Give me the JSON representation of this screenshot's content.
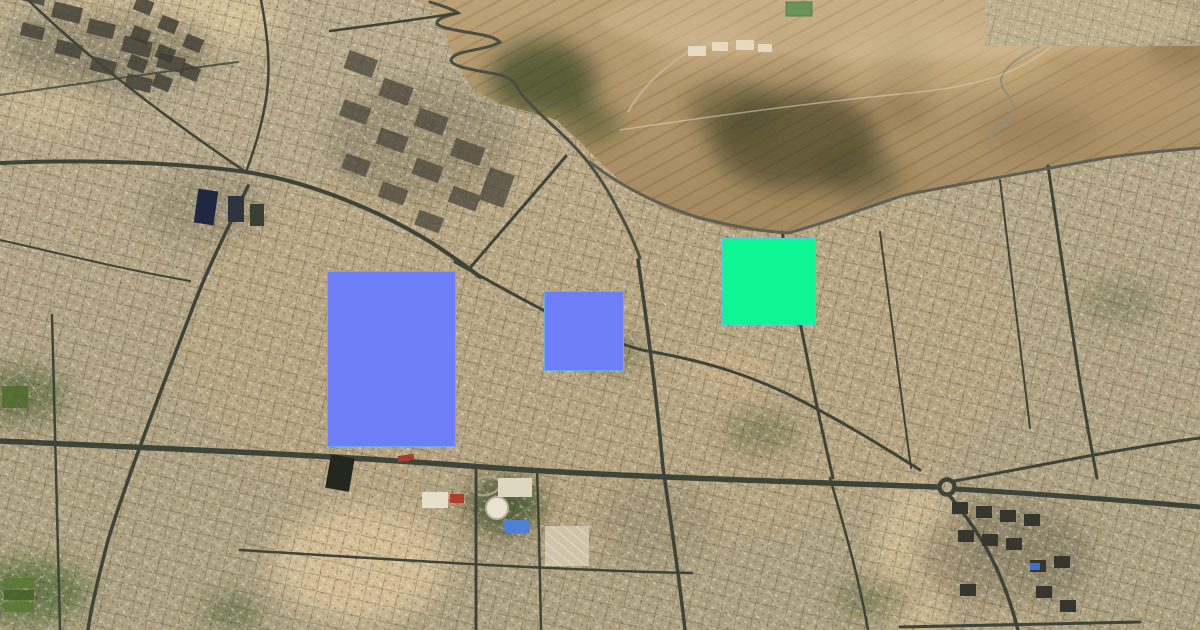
{
  "meta": {
    "title": "Satellite city view with highlighted zones",
    "width_px": 1200,
    "height_px": 630
  },
  "map": {
    "description": "Aerial satellite imagery of a dense desert city; barren rocky hills in the upper right, switchback mountain road at top center, east-west main highway across the lower half with a roundabout at lower right",
    "imagery_colors": {
      "urban_base": "#b3a584",
      "desert_hills": "#a98e66",
      "roads": "#41463a",
      "vegetation": "#3c5128",
      "sand": "#d9c49c"
    }
  },
  "overlays": {
    "blue_large": {
      "name": "blue-rectangle-large",
      "x": 327,
      "y": 271,
      "width": 129,
      "height": 176,
      "color": "#6e7ef8",
      "border": "rgba(100,190,235,0.7)"
    },
    "blue_small": {
      "name": "blue-rectangle-small",
      "x": 544,
      "y": 291,
      "width": 80,
      "height": 80,
      "color": "#6e7ef8",
      "border": "rgba(100,190,235,0.7)"
    },
    "green": {
      "name": "green-rectangle",
      "x": 722,
      "y": 238,
      "width": 94,
      "height": 87,
      "color": "#0ef593",
      "border": "rgba(90,200,230,0.8)"
    }
  }
}
